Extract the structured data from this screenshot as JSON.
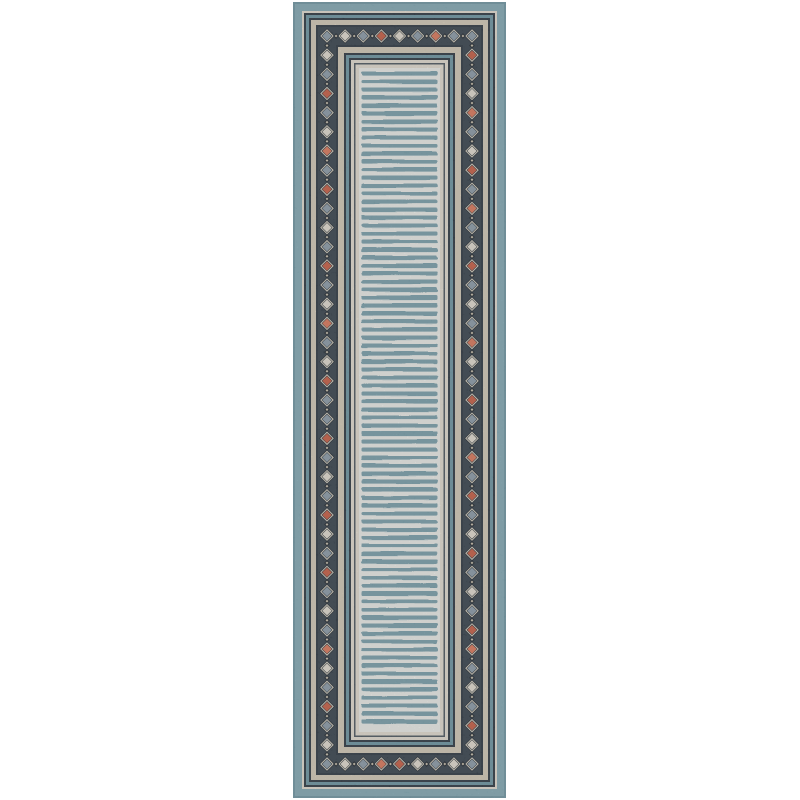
{
  "page": {
    "background": "#ffffff",
    "width": 800,
    "height": 800
  },
  "rug_photo": {
    "alt": "Light blue runner rug with ivory and teal striped center field framed by cream and navy borders and a diamond-motif band in coral, slate blue and ivory",
    "position": {
      "x": 293,
      "y": 2,
      "width": 213,
      "height": 796
    },
    "palette": {
      "outer_band": "#86aeba",
      "outer_band_edge": "#5d8492",
      "ivory": "#e9e3d6",
      "navy": "#2d3741",
      "navy_soft": "#4d5862",
      "teal": "#6f98a6",
      "cream": "#d9cfbc",
      "diamond_band_bg": "#37424d",
      "diamond_backdrop": "#222b34",
      "diamond_outline": "#d9d3c3",
      "coral": "#cd5f45",
      "bright": "#e37b5d",
      "slate": "#8fa0ad",
      "mini_dark": "#202831",
      "mini_light": "#cfc6b2",
      "field_bg": "#f2f4f0",
      "field_stripe": "#7ba3af"
    },
    "frame_bands": [
      {
        "name": "outer-blue-band",
        "inset": 0,
        "color": "outer_band"
      },
      {
        "name": "ivory-line",
        "inset": 9,
        "color": "ivory"
      },
      {
        "name": "navy-line",
        "inset": 11,
        "color": "navy"
      },
      {
        "name": "teal-line",
        "inset": 13,
        "color": "teal"
      },
      {
        "name": "navy-line",
        "inset": 16,
        "color": "navy"
      },
      {
        "name": "cream-band",
        "inset": 18,
        "color": "cream"
      },
      {
        "name": "navy-line",
        "inset": 23,
        "color": "navy"
      },
      {
        "name": "diamond-band",
        "inset": 25,
        "color": "diamond_band_bg"
      },
      {
        "name": "navy-line",
        "inset": 43,
        "color": "navy"
      },
      {
        "name": "cream-band",
        "inset": 45,
        "color": "cream"
      },
      {
        "name": "navy-line",
        "inset": 51,
        "color": "navy"
      },
      {
        "name": "teal-line",
        "inset": 53,
        "color": "teal"
      },
      {
        "name": "navy-line",
        "inset": 56,
        "color": "navy"
      },
      {
        "name": "ivory-line",
        "inset": 58,
        "color": "ivory"
      },
      {
        "name": "soft-navy-line",
        "inset": 61,
        "color": "navy_soft"
      },
      {
        "name": "ivory-line",
        "inset": 62.5,
        "color": "ivory"
      },
      {
        "name": "center-field",
        "inset": 66,
        "color": "field_bg"
      }
    ],
    "diamond_band": {
      "center_inset": 34,
      "backdrop_half": 7.8,
      "outline_half": 6.1,
      "fill_half": 4.7,
      "mini_half": 2.9,
      "mini_inner_half": 1.4,
      "vertical_count": 39,
      "horizontal_intervals": 8,
      "sequences": {
        "left": [
          "slate",
          "ivory",
          "slate",
          "coral",
          "slate",
          "ivory",
          "bright",
          "slate",
          "coral",
          "slate",
          "ivory",
          "slate",
          "coral",
          "slate",
          "ivory",
          "bright",
          "slate",
          "ivory",
          "coral",
          "slate",
          "slate",
          "coral",
          "slate",
          "ivory",
          "slate",
          "coral",
          "ivory",
          "slate",
          "coral",
          "slate",
          "ivory",
          "slate",
          "bright",
          "ivory",
          "slate",
          "coral",
          "slate",
          "ivory",
          "slate"
        ],
        "right": [
          "slate",
          "coral",
          "slate",
          "ivory",
          "bright",
          "slate",
          "ivory",
          "coral",
          "slate",
          "bright",
          "slate",
          "ivory",
          "coral",
          "slate",
          "ivory",
          "slate",
          "bright",
          "ivory",
          "slate",
          "coral",
          "slate",
          "ivory",
          "bright",
          "slate",
          "coral",
          "slate",
          "ivory",
          "coral",
          "slate",
          "ivory",
          "slate",
          "coral",
          "bright",
          "slate",
          "ivory",
          "slate",
          "coral",
          "ivory",
          "slate"
        ],
        "top": [
          "ivory",
          "slate",
          "coral",
          "ivory",
          "slate",
          "bright",
          "slate"
        ],
        "bottom": [
          "ivory",
          "slate",
          "bright",
          "coral",
          "ivory",
          "slate",
          "ivory"
        ]
      }
    },
    "field": {
      "stripe_period": 8,
      "stripe_height": 4.1,
      "stripe_side_inset": 2.5,
      "stripe_start_gap": 3.5
    }
  }
}
